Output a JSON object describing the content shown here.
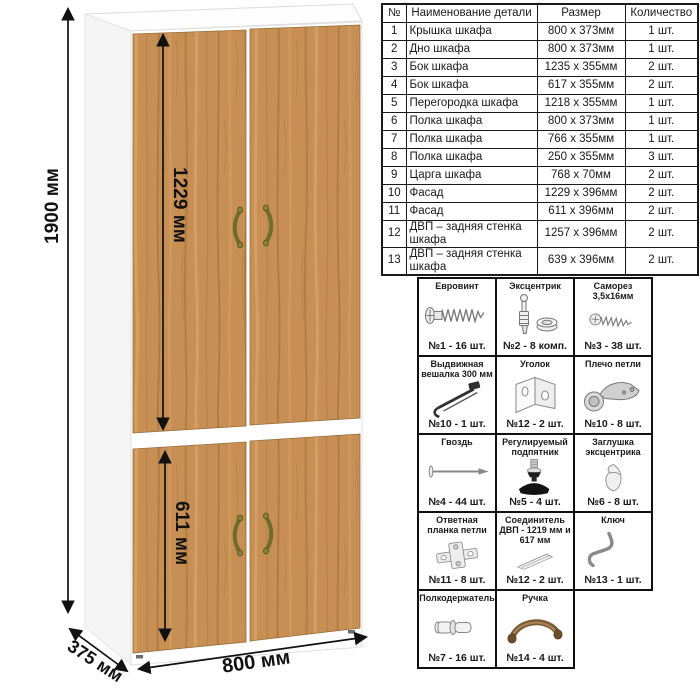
{
  "wardrobe": {
    "dimensions": {
      "height": "1900 мм",
      "upper_door": "1229 мм",
      "lower_door": "611 мм",
      "width": "800 мм",
      "depth": "375 мм"
    },
    "colors": {
      "wood": "#c78f54",
      "wood_grain_dark": "#9d6c36",
      "carcass": "#ffffff",
      "handle": "#6f6c2c",
      "dimension_lines": "#111111"
    }
  },
  "parts_table": {
    "headers": [
      "№",
      "Наименование детали",
      "Размер",
      "Количество"
    ],
    "rows": [
      {
        "num": "1",
        "name": "Крышка шкафа",
        "size": "800 x 373мм",
        "qty": "1 шт."
      },
      {
        "num": "2",
        "name": "Дно шкафа",
        "size": "800 x 373мм",
        "qty": "1 шт."
      },
      {
        "num": "3",
        "name": "Бок шкафа",
        "size": "1235 x 355мм",
        "qty": "2 шт."
      },
      {
        "num": "4",
        "name": "Бок шкафа",
        "size": "617 x 355мм",
        "qty": "2 шт."
      },
      {
        "num": "5",
        "name": "Перегородка шкафа",
        "size": "1218 x 355мм",
        "qty": "1 шт."
      },
      {
        "num": "6",
        "name": "Полка шкафа",
        "size": "800 x 373мм",
        "qty": "1 шт."
      },
      {
        "num": "7",
        "name": "Полка шкафа",
        "size": "766 x 355мм",
        "qty": "1 шт."
      },
      {
        "num": "8",
        "name": "Полка шкафа",
        "size": "250 x 355мм",
        "qty": "3 шт."
      },
      {
        "num": "9",
        "name": "Царга шкафа",
        "size": "768 x 70мм",
        "qty": "2 шт."
      },
      {
        "num": "10",
        "name": "Фасад",
        "size": "1229 x 396мм",
        "qty": "2 шт."
      },
      {
        "num": "11",
        "name": "Фасад",
        "size": "611 x 396мм",
        "qty": "2 шт."
      },
      {
        "num": "12",
        "name": "ДВП – задняя стенка шкафа",
        "size": "1257 x 396мм",
        "qty": "2 шт."
      },
      {
        "num": "13",
        "name": "ДВП – задняя стенка шкафа",
        "size": "639 x 396мм",
        "qty": "2 шт."
      }
    ]
  },
  "hardware": {
    "items": [
      {
        "name": "Евровинт",
        "count": "№1 - 16 шт.",
        "icon": "euro-screw-icon",
        "icon_href": "#glyph-euro-screw"
      },
      {
        "name": "Эксцентрик",
        "count": "№2 - 8 комп.",
        "icon": "eccentric-cam-icon",
        "icon_href": "#glyph-eccentric"
      },
      {
        "name": "Саморез 3,5x16мм",
        "count": "№3 - 38 шт.",
        "icon": "screw-icon",
        "icon_href": "#glyph-screw"
      },
      {
        "name": "Выдвижная вешалка 300 мм",
        "count": "№10 - 1 шт.",
        "icon": "pullout-hanger-icon",
        "icon_href": "#glyph-hanger"
      },
      {
        "name": "Уголок",
        "count": "№12 - 2 шт.",
        "icon": "corner-bracket-icon",
        "icon_href": "#glyph-bracket"
      },
      {
        "name": "Плечо петли",
        "count": "№10 - 8 шт.",
        "icon": "hinge-arm-icon",
        "icon_href": "#glyph-hinge-arm"
      },
      {
        "name": "Гвоздь",
        "count": "№4 - 44 шт.",
        "icon": "nail-icon",
        "icon_href": "#glyph-nail"
      },
      {
        "name": "Регулируемый подпятник",
        "count": "№5 - 4 шт.",
        "icon": "adjustable-foot-icon",
        "icon_href": "#glyph-foot"
      },
      {
        "name": "Заглушка эксцентрика",
        "count": "№6 - 8 шт.",
        "icon": "cam-cap-icon",
        "icon_href": "#glyph-cap"
      },
      {
        "name": "Ответная планка петли",
        "count": "№11 - 8 шт.",
        "icon": "hinge-plate-icon",
        "icon_href": "#glyph-hinge-plate"
      },
      {
        "name": "Соединитель ДВП - 1219 мм и 617 мм",
        "count": "№12 - 2 шт.",
        "icon": "hdf-connector-icon",
        "icon_href": "#glyph-connector"
      },
      {
        "name": "Ключ",
        "count": "№13 - 1 шт.",
        "icon": "key-icon",
        "icon_href": "#glyph-key"
      },
      {
        "name": "Полкодержатель",
        "count": "№7 - 16 шт.",
        "icon": "shelf-pin-icon",
        "icon_href": "#glyph-shelf-pin"
      },
      {
        "name": "Ручка",
        "count": "№14 - 4 шт.",
        "icon": "handle-icon",
        "icon_href": "#glyph-handle"
      }
    ]
  }
}
